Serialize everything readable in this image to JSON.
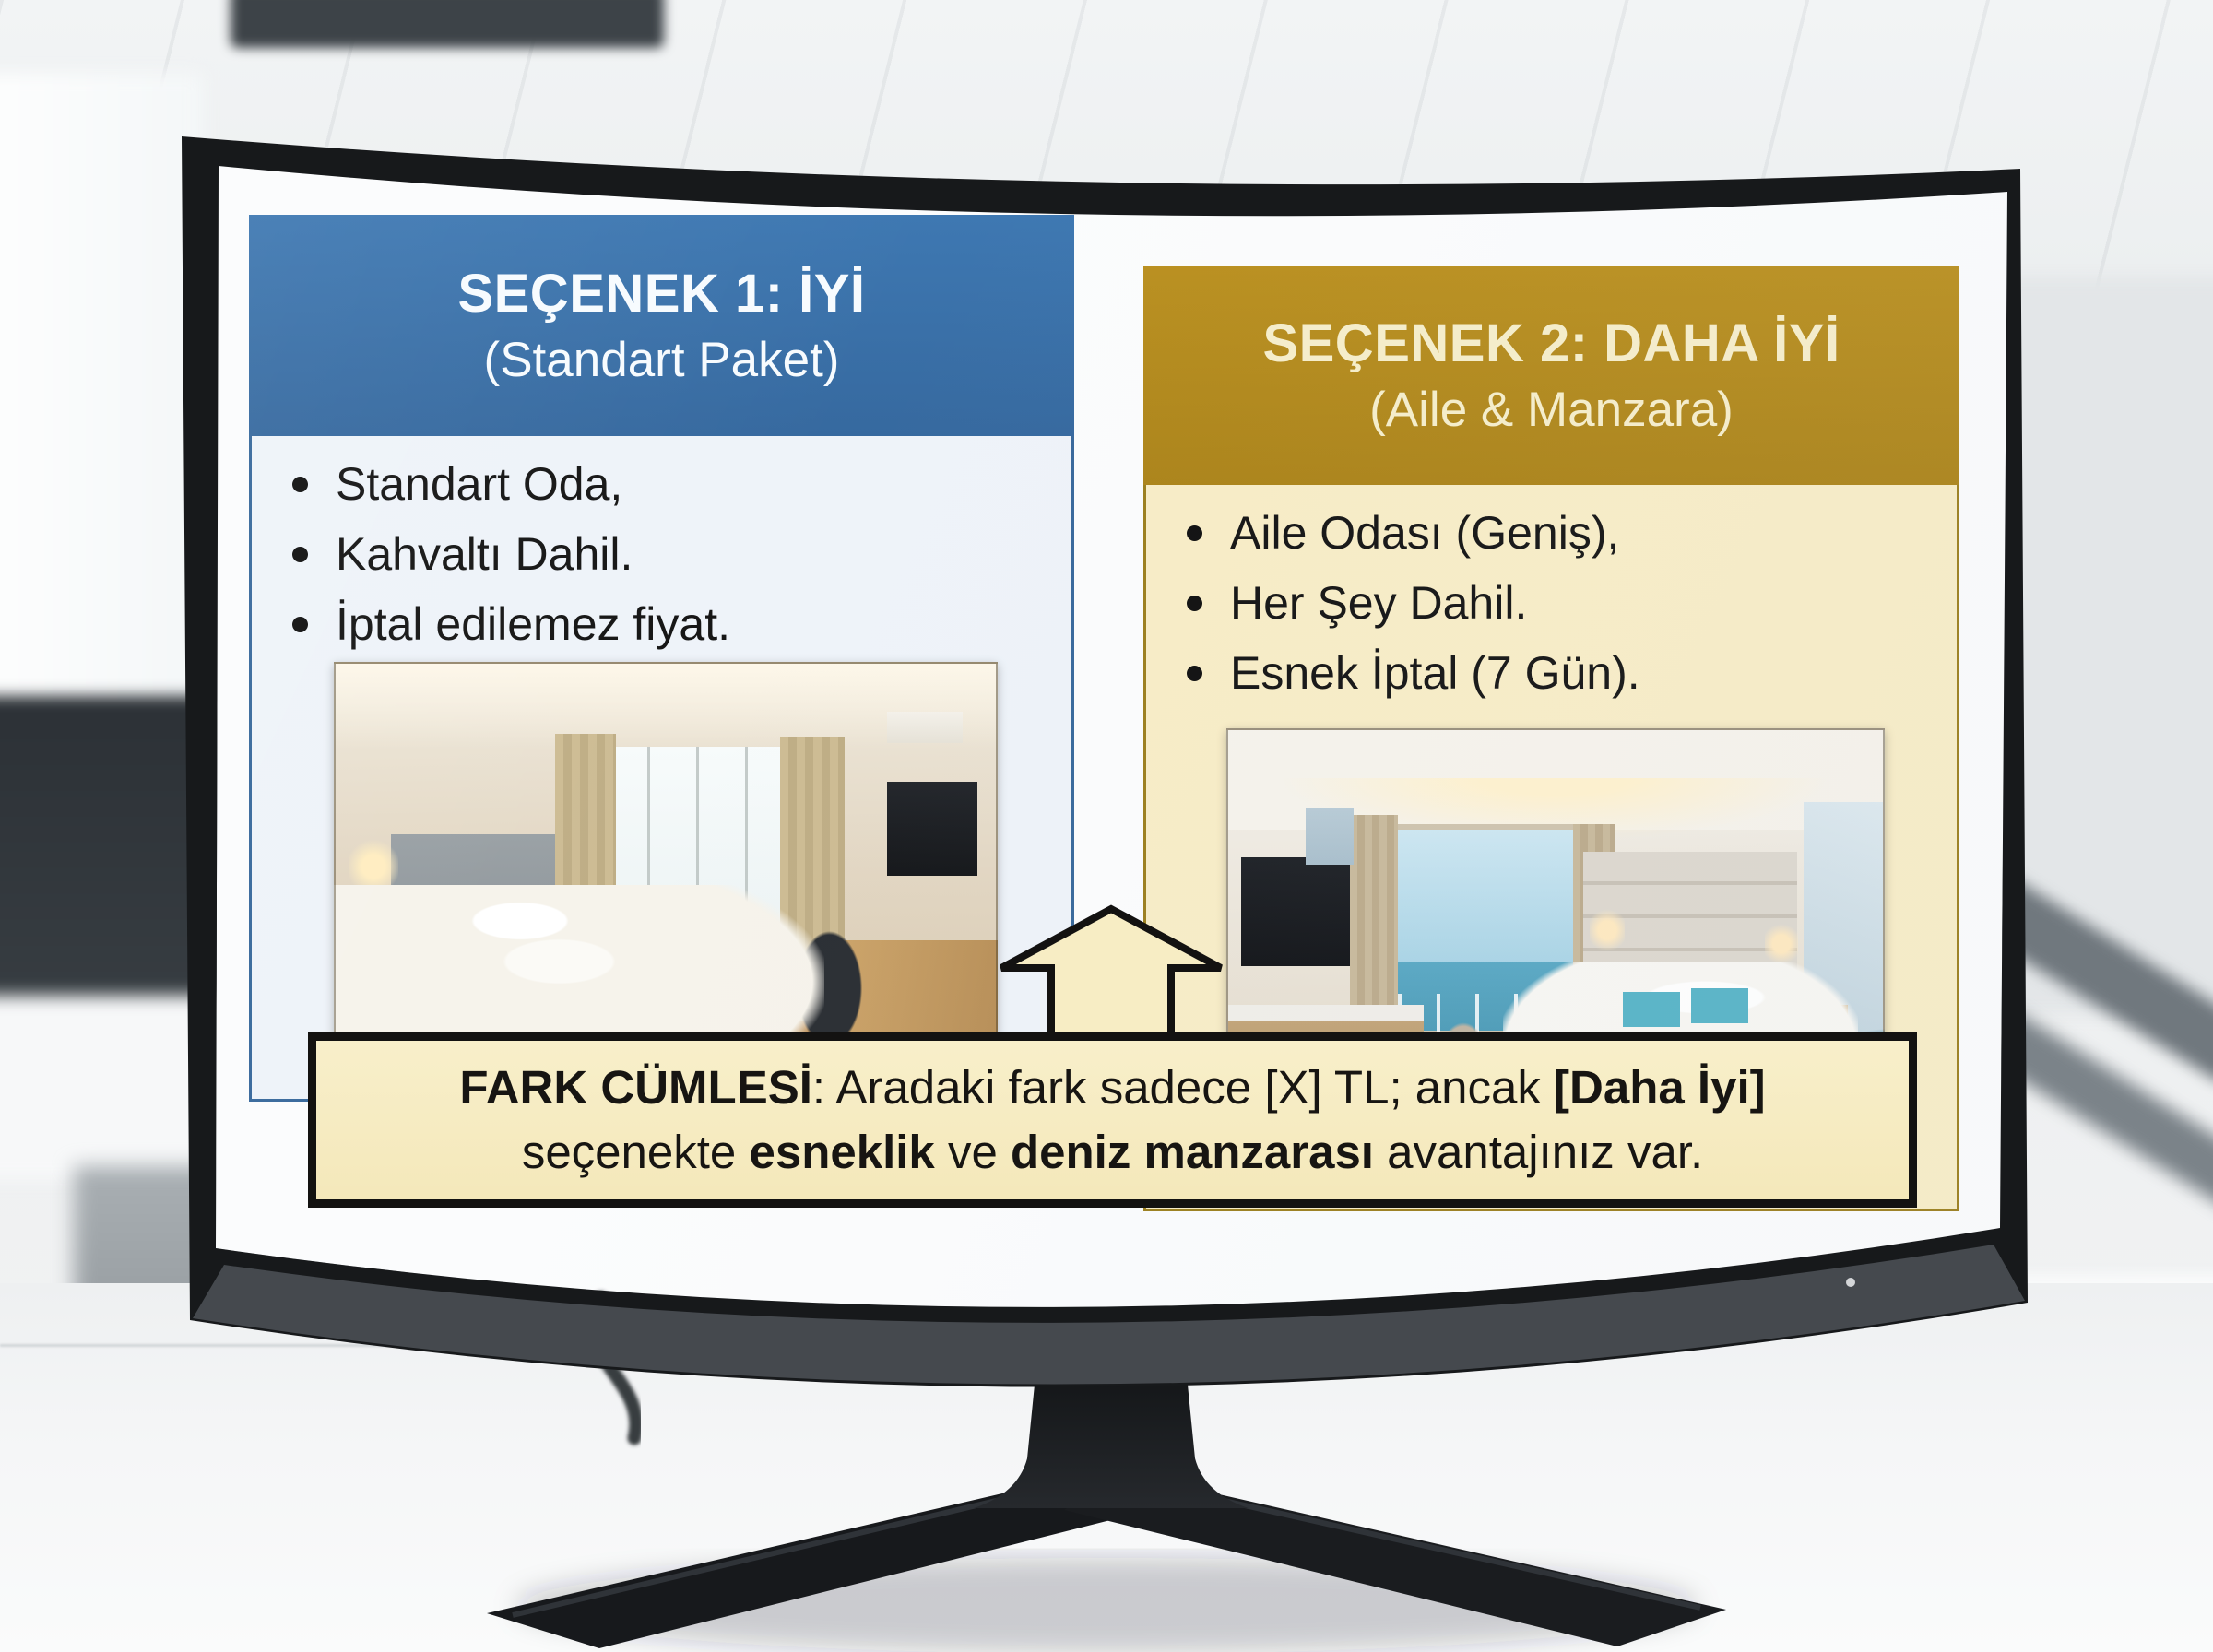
{
  "colors": {
    "option1_header": "#3b74ad",
    "option1_body": "#eef3f9",
    "option2_header": "#b68d1d",
    "option2_body": "#f8edc7",
    "banner_bg": "#f7edc6",
    "banner_border": "#131211",
    "bezel": "#17191b"
  },
  "slide": {
    "options": [
      {
        "title": "SEÇENEK 1: İYİ",
        "subtitle": "(Standart Paket)",
        "bullets": [
          "Standart Oda,",
          "Kahvaltı Dahil.",
          "İptal edilemez fiyat."
        ]
      },
      {
        "title": "SEÇENEK 2: DAHA İYİ",
        "subtitle": "(Aile & Manzara)",
        "bullets": [
          "Aile Odası (Geniş),",
          "Her Şey Dahil.",
          "Esnek İptal (7 Gün)."
        ]
      }
    ],
    "banner": {
      "line1": [
        {
          "text": "FARK CÜMLESİ"
        },
        {
          "text": ": Aradaki fark sadece [X] TL; ancak "
        },
        {
          "text": "[Daha İyi]"
        }
      ],
      "line2": [
        {
          "text": "seçenekte "
        },
        {
          "text": "esneklik"
        },
        {
          "text": " ve "
        },
        {
          "text": "deniz manzarası"
        },
        {
          "text": " avantajınız var."
        }
      ]
    }
  }
}
